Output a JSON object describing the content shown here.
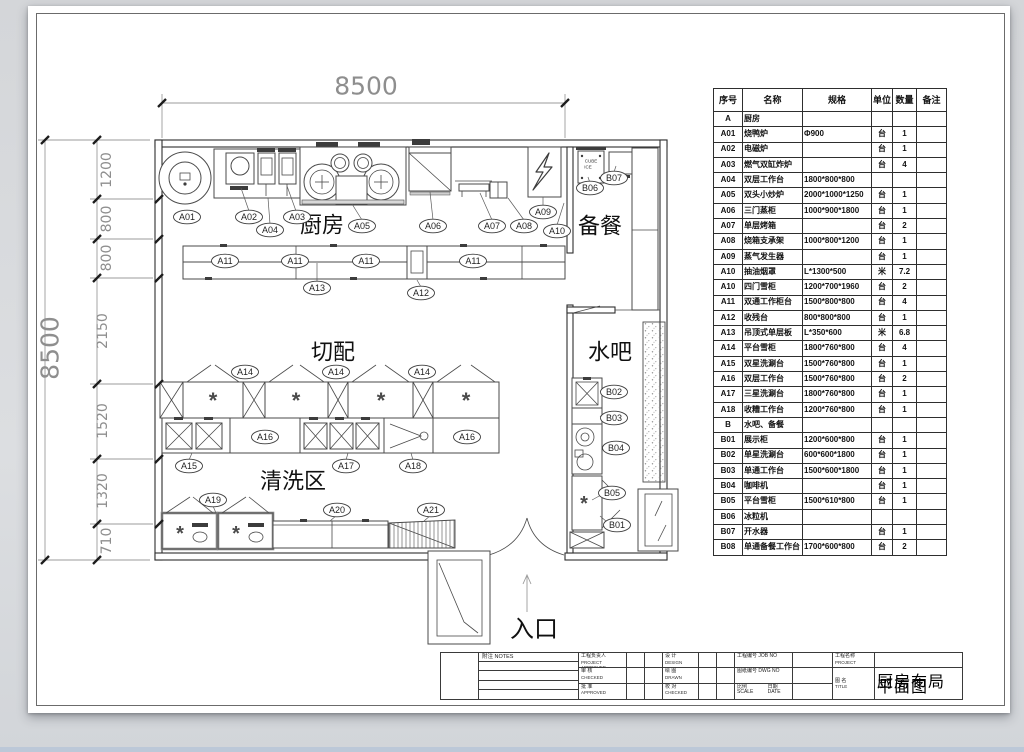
{
  "colors": {
    "sheet": "#ffffff",
    "ink": "#2f2f2f",
    "dim": "#8e8e8e",
    "backdrop": "#d8dadd",
    "bottom_strip": "#bcc8d8"
  },
  "plan": {
    "labels": [
      {
        "type": "dim",
        "text": "8500",
        "x": 366,
        "y": 86,
        "size": 25
      },
      {
        "type": "dim",
        "text": "8500",
        "x": 50,
        "y": 348,
        "size": 25,
        "rot": -90
      },
      {
        "type": "dim",
        "text": "1200",
        "x": 107,
        "y": 170,
        "size": 14,
        "rot": -90
      },
      {
        "type": "dim",
        "text": "800",
        "x": 107,
        "y": 219,
        "size": 14,
        "rot": -90
      },
      {
        "type": "dim",
        "text": "800",
        "x": 107,
        "y": 258,
        "size": 14,
        "rot": -90
      },
      {
        "type": "dim",
        "text": "2150",
        "x": 103,
        "y": 331,
        "size": 14,
        "rot": -90
      },
      {
        "type": "dim",
        "text": "1520",
        "x": 103,
        "y": 421,
        "size": 14,
        "rot": -90
      },
      {
        "type": "dim",
        "text": "1320",
        "x": 103,
        "y": 491,
        "size": 14,
        "rot": -90
      },
      {
        "type": "dim",
        "text": "710",
        "x": 107,
        "y": 541,
        "size": 14,
        "rot": -90
      },
      {
        "type": "room",
        "text": "厨房",
        "x": 322,
        "y": 226,
        "size": 22
      },
      {
        "type": "room",
        "text": "备餐",
        "x": 600,
        "y": 227,
        "size": 22
      },
      {
        "type": "room",
        "text": "切配",
        "x": 333,
        "y": 353,
        "size": 22
      },
      {
        "type": "room",
        "text": "水吧",
        "x": 610,
        "y": 353,
        "size": 22
      },
      {
        "type": "room",
        "text": "清洗区",
        "x": 293,
        "y": 482,
        "size": 22
      },
      {
        "type": "room",
        "text": "入口",
        "x": 534,
        "y": 629,
        "size": 24
      },
      {
        "type": "bubble",
        "text": "A01",
        "x": 187,
        "y": 217
      },
      {
        "type": "bubble",
        "text": "A02",
        "x": 249,
        "y": 217
      },
      {
        "type": "bubble",
        "text": "A04",
        "x": 270,
        "y": 230
      },
      {
        "type": "bubble",
        "text": "A03",
        "x": 297,
        "y": 217
      },
      {
        "type": "bubble",
        "text": "A05",
        "x": 362,
        "y": 226
      },
      {
        "type": "bubble",
        "text": "A06",
        "x": 433,
        "y": 226
      },
      {
        "type": "bubble",
        "text": "A07",
        "x": 492,
        "y": 226
      },
      {
        "type": "bubble",
        "text": "A08",
        "x": 524,
        "y": 226
      },
      {
        "type": "bubble",
        "text": "A10",
        "x": 557,
        "y": 231
      },
      {
        "type": "bubble",
        "text": "A09",
        "x": 543,
        "y": 212
      },
      {
        "type": "bubble",
        "text": "B06",
        "x": 590,
        "y": 188
      },
      {
        "type": "bubble",
        "text": "B07",
        "x": 614,
        "y": 178
      },
      {
        "type": "bubble",
        "text": "A11",
        "x": 225,
        "y": 261
      },
      {
        "type": "bubble",
        "text": "A11",
        "x": 295,
        "y": 261
      },
      {
        "type": "bubble",
        "text": "A11",
        "x": 366,
        "y": 261
      },
      {
        "type": "bubble",
        "text": "A11",
        "x": 473,
        "y": 261
      },
      {
        "type": "bubble",
        "text": "A13",
        "x": 317,
        "y": 288
      },
      {
        "type": "bubble",
        "text": "A12",
        "x": 421,
        "y": 293
      },
      {
        "type": "bubble",
        "text": "A14",
        "x": 245,
        "y": 372
      },
      {
        "type": "bubble",
        "text": "A14",
        "x": 336,
        "y": 372
      },
      {
        "type": "bubble",
        "text": "A14",
        "x": 422,
        "y": 372
      },
      {
        "type": "bubble",
        "text": "A15",
        "x": 189,
        "y": 466
      },
      {
        "type": "bubble",
        "text": "A16",
        "x": 265,
        "y": 437
      },
      {
        "type": "bubble",
        "text": "A17",
        "x": 346,
        "y": 466
      },
      {
        "type": "bubble",
        "text": "A18",
        "x": 413,
        "y": 466
      },
      {
        "type": "bubble",
        "text": "A16",
        "x": 467,
        "y": 437
      },
      {
        "type": "bubble",
        "text": "A19",
        "x": 213,
        "y": 500
      },
      {
        "type": "bubble",
        "text": "A20",
        "x": 337,
        "y": 510
      },
      {
        "type": "bubble",
        "text": "A21",
        "x": 431,
        "y": 510
      },
      {
        "type": "bubble",
        "text": "B02",
        "x": 614,
        "y": 392
      },
      {
        "type": "bubble",
        "text": "B03",
        "x": 614,
        "y": 418
      },
      {
        "type": "bubble",
        "text": "B04",
        "x": 616,
        "y": 448
      },
      {
        "type": "bubble",
        "text": "B05",
        "x": 612,
        "y": 493
      },
      {
        "type": "bubble",
        "text": "B01",
        "x": 617,
        "y": 525
      },
      {
        "type": "glyph",
        "text": "*",
        "x": 213,
        "y": 408,
        "size": 22
      },
      {
        "type": "glyph",
        "text": "*",
        "x": 296,
        "y": 408,
        "size": 22
      },
      {
        "type": "glyph",
        "text": "*",
        "x": 381,
        "y": 408,
        "size": 22
      },
      {
        "type": "glyph",
        "text": "*",
        "x": 466,
        "y": 408,
        "size": 22
      },
      {
        "type": "glyph",
        "text": "*",
        "x": 180,
        "y": 540,
        "size": 20
      },
      {
        "type": "glyph",
        "text": "*",
        "x": 236,
        "y": 540,
        "size": 20
      },
      {
        "type": "glyph",
        "text": "*",
        "x": 584,
        "y": 510,
        "size": 20
      },
      {
        "type": "tiny",
        "text": "CUBE",
        "x": 591,
        "y": 161,
        "size": 4.5
      },
      {
        "type": "tiny",
        "text": "ICE",
        "x": 588,
        "y": 167,
        "size": 4.5
      }
    ]
  },
  "equipment_table": {
    "headers": [
      "序号",
      "名称",
      "规格",
      "单位",
      "数量",
      "备注"
    ],
    "rows": [
      [
        "A",
        "厨房",
        "",
        "",
        "",
        ""
      ],
      [
        "A01",
        "烧鸭炉",
        "Φ900",
        "台",
        "1",
        ""
      ],
      [
        "A02",
        "电磁炉",
        "",
        "台",
        "1",
        ""
      ],
      [
        "A03",
        "燃气双缸炸炉",
        "",
        "台",
        "4",
        ""
      ],
      [
        "A04",
        "双层工作台",
        "1800*800*800",
        "",
        "",
        ""
      ],
      [
        "A05",
        "双头小炒炉",
        "2000*1000*1250",
        "台",
        "1",
        ""
      ],
      [
        "A06",
        "三门蒸柜",
        "1000*900*1800",
        "台",
        "1",
        ""
      ],
      [
        "A07",
        "单层烤箱",
        "",
        "台",
        "2",
        ""
      ],
      [
        "A08",
        "烧箱支承架",
        "1000*800*1200",
        "台",
        "1",
        ""
      ],
      [
        "A09",
        "蒸气发生器",
        "",
        "台",
        "1",
        ""
      ],
      [
        "A10",
        "抽油烟罩",
        "L*1300*500",
        "米",
        "7.2",
        ""
      ],
      [
        "A10",
        "四门雪柜",
        "1200*700*1960",
        "台",
        "2",
        ""
      ],
      [
        "A11",
        "双通工作柜台",
        "1500*800*800",
        "台",
        "4",
        ""
      ],
      [
        "A12",
        "收残台",
        "800*800*800",
        "台",
        "1",
        ""
      ],
      [
        "A13",
        "吊顶式单层板",
        "L*350*600",
        "米",
        "6.8",
        ""
      ],
      [
        "A14",
        "平台雪柜",
        "1800*760*800",
        "台",
        "4",
        ""
      ],
      [
        "A15",
        "双星洗涮台",
        "1500*760*800",
        "台",
        "1",
        ""
      ],
      [
        "A16",
        "双层工作台",
        "1500*760*800",
        "台",
        "2",
        ""
      ],
      [
        "A17",
        "三星洗涮台",
        "1800*760*800",
        "台",
        "1",
        ""
      ],
      [
        "A18",
        "收糟工作台",
        "1200*760*800",
        "台",
        "1",
        ""
      ],
      [
        "B",
        "水吧、备餐",
        "",
        "",
        "",
        ""
      ],
      [
        "B01",
        "展示柜",
        "1200*600*800",
        "台",
        "1",
        ""
      ],
      [
        "B02",
        "单星洗涮台",
        "600*600*1800",
        "台",
        "1",
        ""
      ],
      [
        "B03",
        "单通工作台",
        "1500*600*1800",
        "台",
        "1",
        ""
      ],
      [
        "B04",
        "咖啡机",
        "",
        "台",
        "1",
        ""
      ],
      [
        "B05",
        "平台雪柜",
        "1500*610*800",
        "台",
        "1",
        ""
      ],
      [
        "B06",
        "冰粒机",
        "",
        "",
        "",
        ""
      ],
      [
        "B07",
        "开水器",
        "",
        "台",
        "1",
        ""
      ],
      [
        "B08",
        "单通备餐工作台",
        "1700*600*800",
        "台",
        "2",
        ""
      ]
    ]
  },
  "title_block": {
    "notes_label": "附注  NOTES",
    "left_rows": [
      {
        "cn": "工程负责人",
        "en": "PROJECT APPROVED"
      },
      {
        "cn": "审 核",
        "en": "CHECKED"
      },
      {
        "cn": "批 准",
        "en": "APPROVED"
      }
    ],
    "mid_rows": [
      {
        "cn": "设 计",
        "en": "DESIGN"
      },
      {
        "cn": "绘 图",
        "en": "DRAWN"
      },
      {
        "cn": "校 对",
        "en": "CHECKED"
      }
    ],
    "right_rows": [
      {
        "cn": "工程编号",
        "en": "JOB NO"
      },
      {
        "cn": "图纸编号",
        "en": "DWG NO"
      }
    ],
    "scale_cn": "比例",
    "scale_en": "SCALE",
    "date_cn": "日期",
    "date_en": "DATE",
    "project_cn": "工程名称",
    "project_en": "PROJECT",
    "title_cn": "图 名",
    "title_en": "TITLE",
    "drawing_title": "厨房布局平面图"
  }
}
